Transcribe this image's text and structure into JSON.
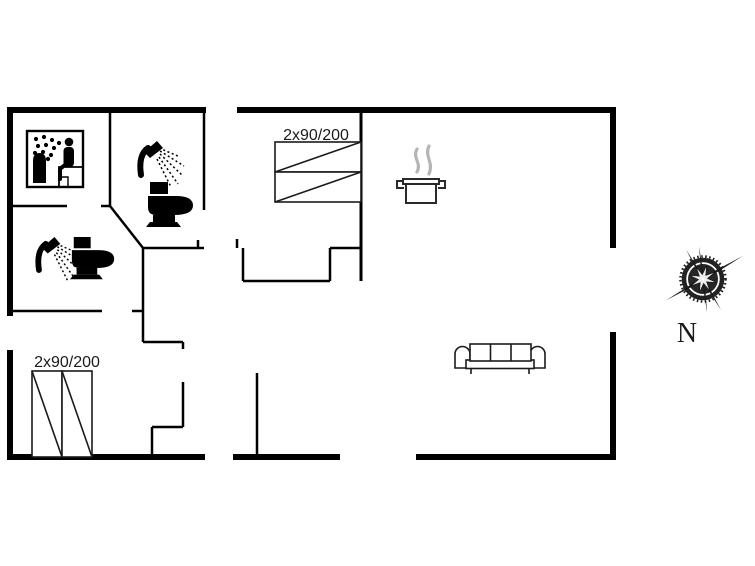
{
  "floorplan": {
    "labels": {
      "bed_top": "2x90/200",
      "bed_bottom": "2x90/200",
      "compass_north": "N"
    },
    "icons": [
      "sauna-icon",
      "shower-icon",
      "toilet-icon",
      "shower-icon",
      "toilet-icon",
      "cooking-pot-icon",
      "steam-icon",
      "sofa-icon",
      "bed-symbol",
      "bed-symbol",
      "compass-rose-icon"
    ],
    "colors": {
      "wall": "#000000",
      "icon": "#000000",
      "furniture_outline": "#1a1a1a",
      "steam": "#b5b5b5",
      "background": "#ffffff"
    }
  }
}
